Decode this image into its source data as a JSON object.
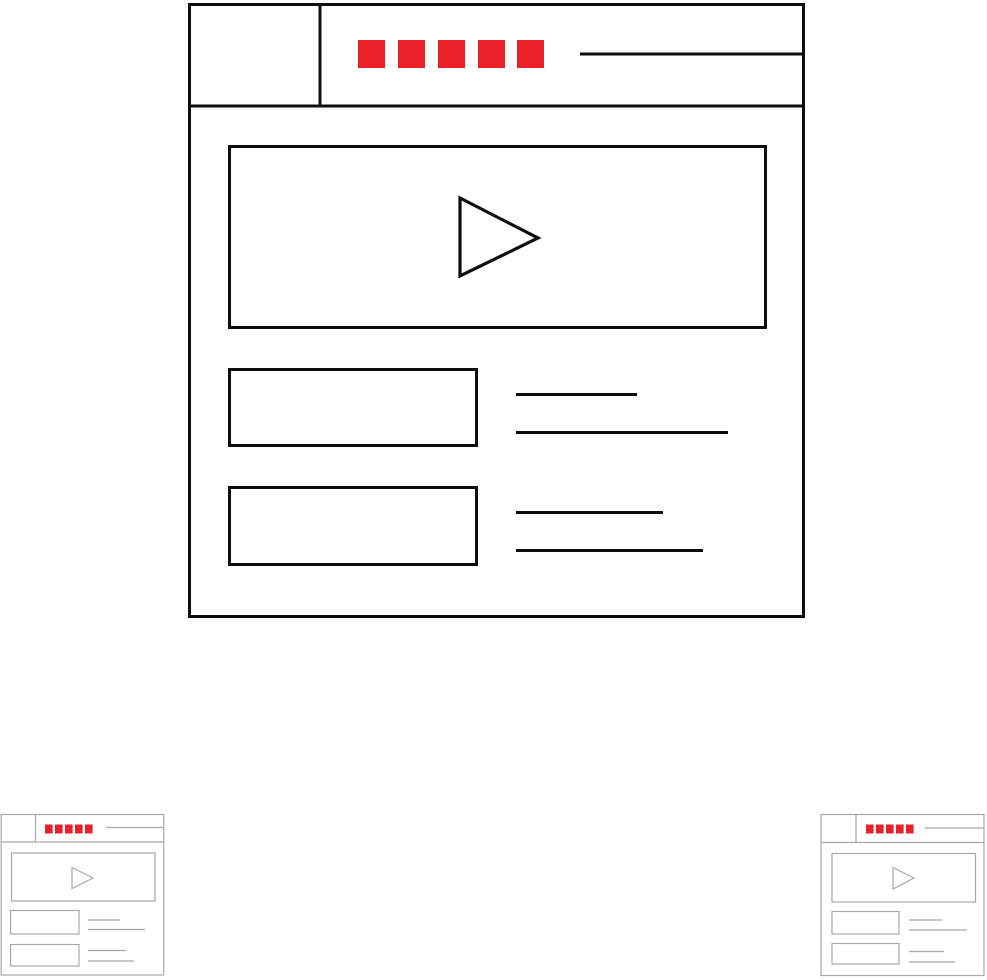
{
  "canvas": {
    "width": 987,
    "height": 980,
    "background": "#ffffff"
  },
  "palette": {
    "accent_red": "#e8212a",
    "stroke_bold_black": "#0d0d0d",
    "stroke_thin_gray": "#a8a8a8",
    "fill_white": "#ffffff"
  },
  "icons": [
    {
      "id": "video-player-browser-large",
      "variant": "bold-line",
      "stroke": "#0d0d0d",
      "menu_square_count": 5,
      "content_boxes": 2,
      "text_lines": 4,
      "has_play_button": true
    },
    {
      "id": "video-player-browser-small-left",
      "variant": "thin-line",
      "stroke": "#a8a8a8",
      "menu_square_count": 5,
      "content_boxes": 2,
      "text_lines": 4,
      "has_play_button": true
    },
    {
      "id": "video-player-browser-small-right",
      "variant": "thin-line",
      "stroke": "#a8a8a8",
      "menu_square_count": 5,
      "content_boxes": 2,
      "text_lines": 4,
      "has_play_button": true
    }
  ]
}
